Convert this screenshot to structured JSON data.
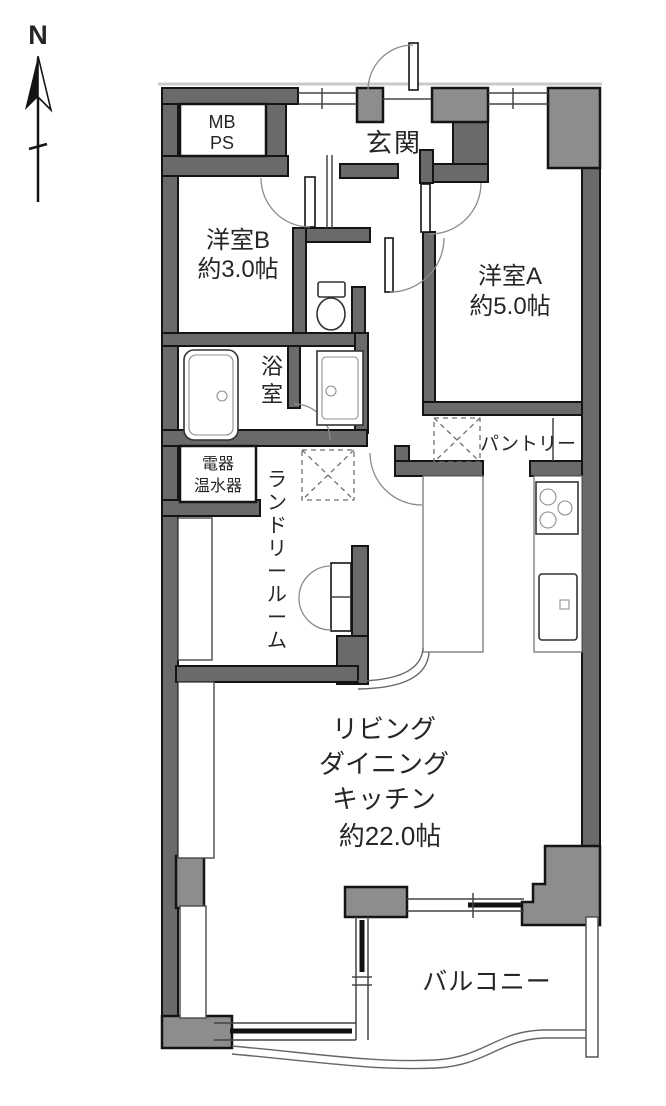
{
  "title": "マンション間取り図",
  "compass": {
    "north_label": "N"
  },
  "labels": {
    "meter_box": "MB",
    "pipe_space": "PS",
    "entrance": "玄関",
    "room_b": {
      "name": "洋室B",
      "size": "約3.0帖"
    },
    "room_a": {
      "name": "洋室A",
      "size": "約5.0帖"
    },
    "bathroom": "浴室",
    "pantry": "パントリー",
    "water_heater": {
      "line1": "電器",
      "line2": "温水器"
    },
    "laundry_room": "ランドリールーム",
    "ldk": {
      "line1": "リビング",
      "line2": "ダイニング",
      "line3": "キッチン",
      "size": "約22.0帖"
    },
    "balcony": "バルコニー"
  },
  "colors": {
    "wall_fill": "#6a6a6a",
    "pillar_fill": "#8d8d8d",
    "outline": "#141414",
    "floor": "#ffffff"
  }
}
